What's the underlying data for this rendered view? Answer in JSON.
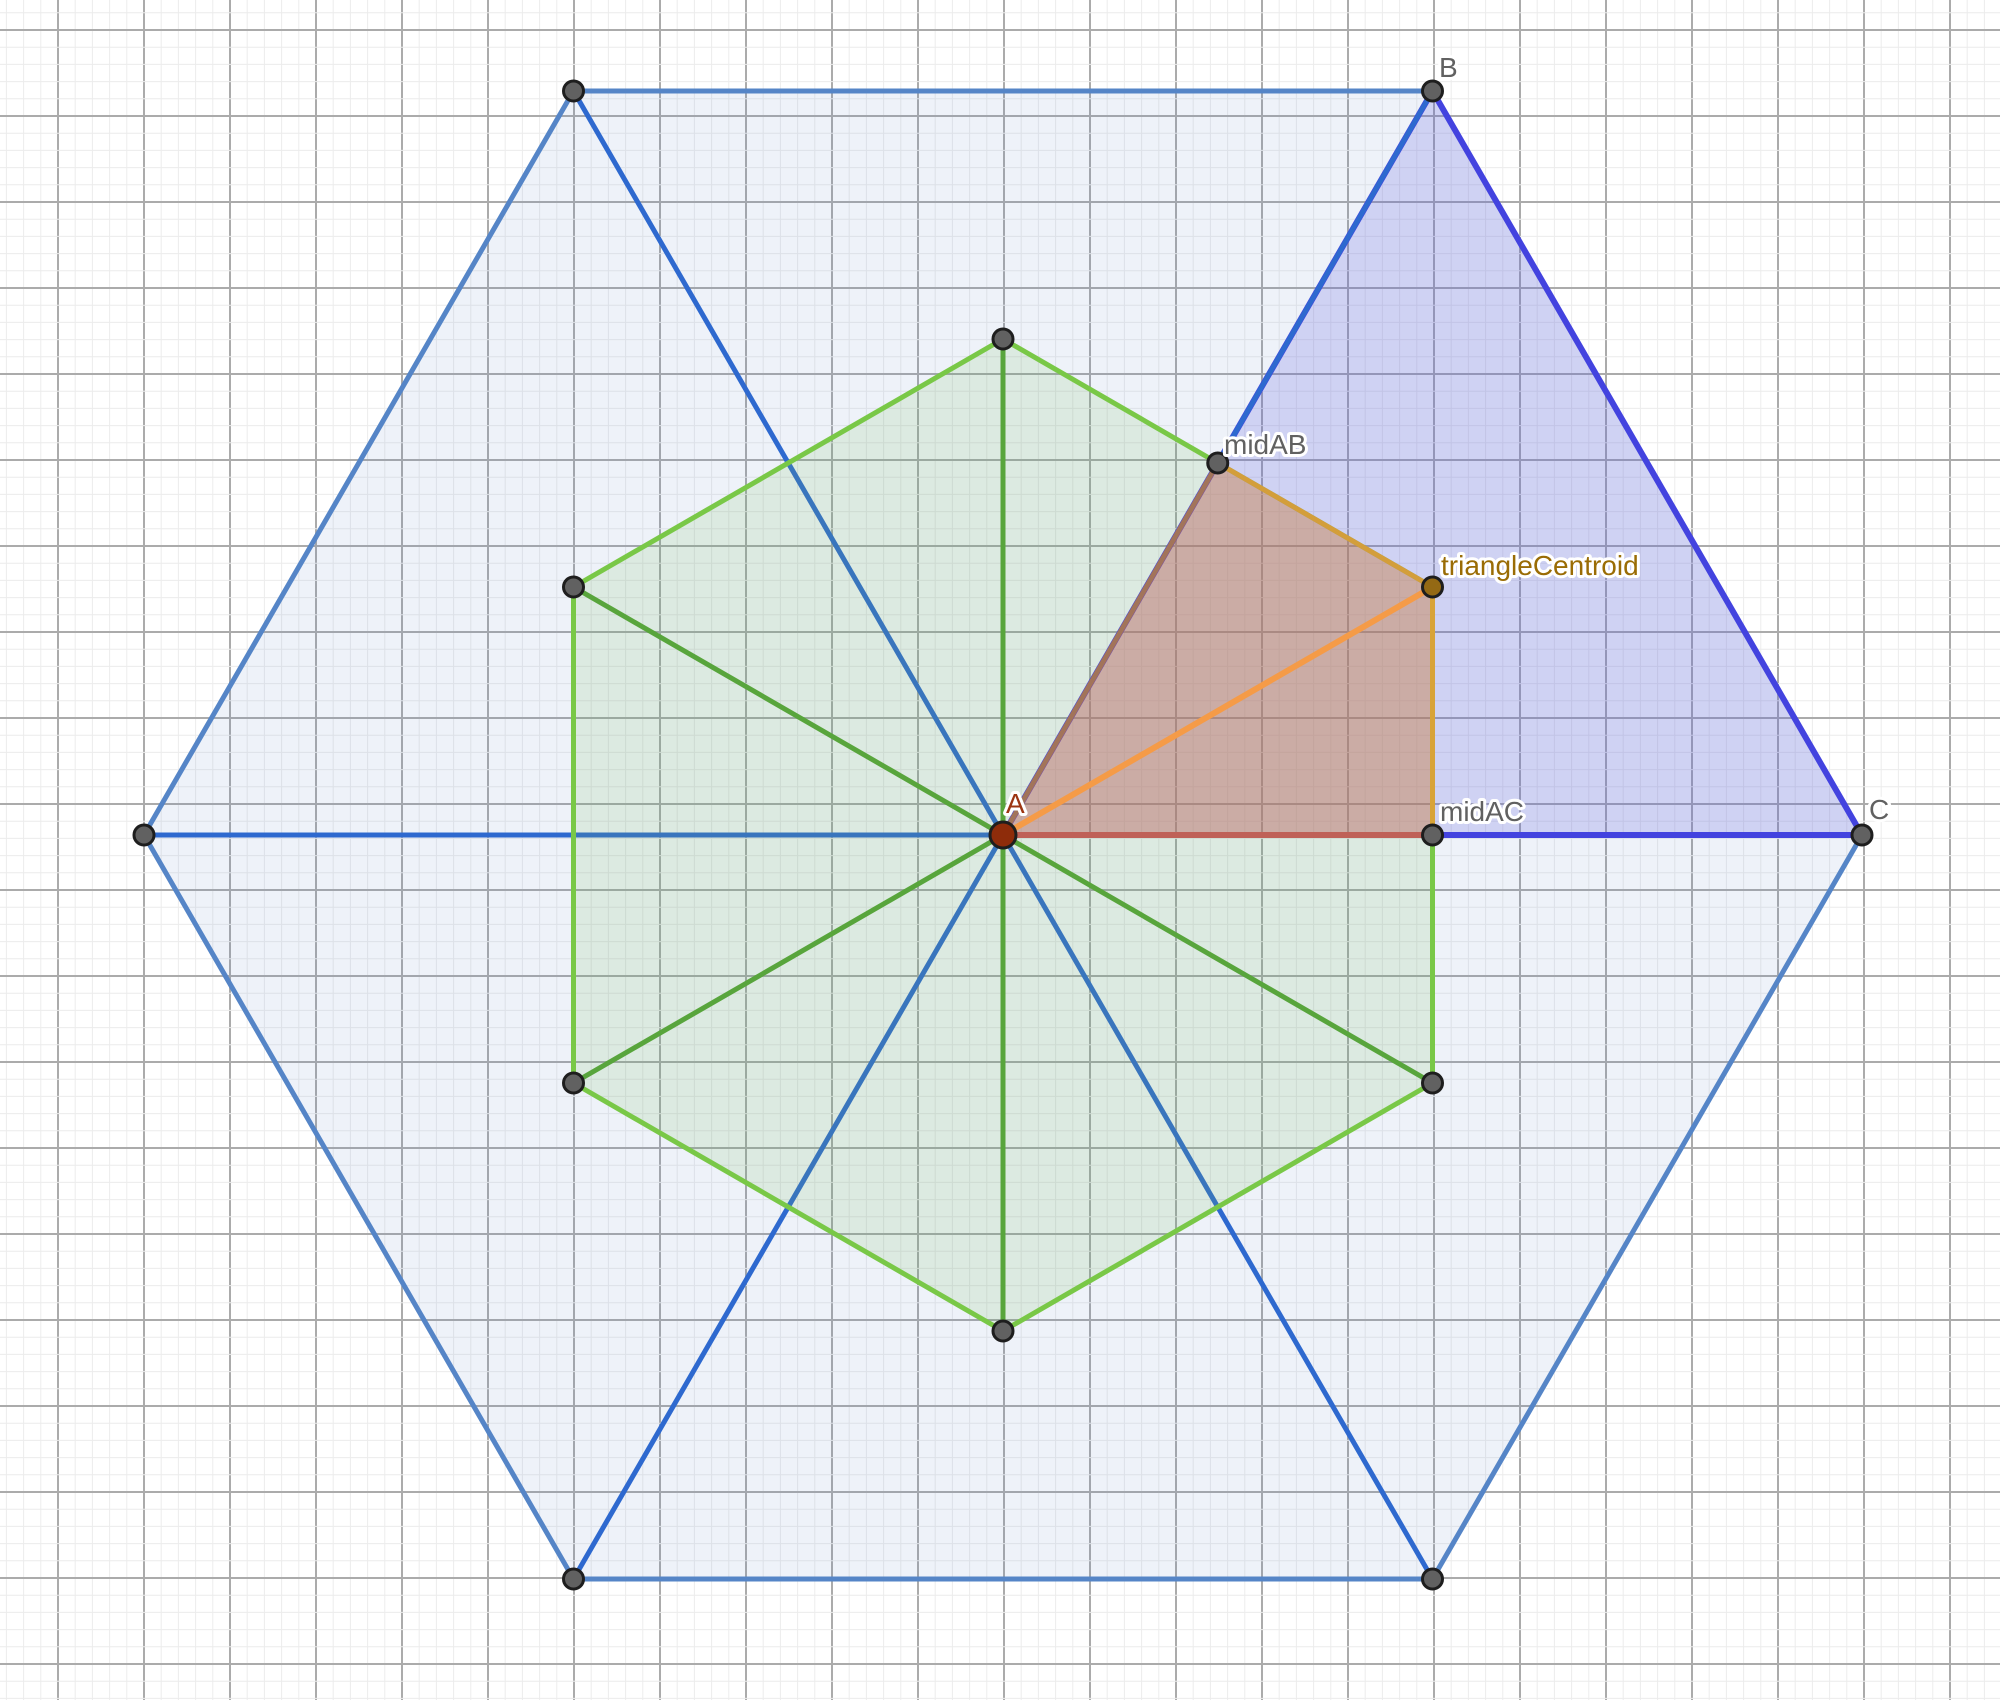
{
  "app": {
    "title": "geometry-graphics-view"
  },
  "canvas": {
    "width": 2000,
    "height": 1700,
    "background": "#ffffff"
  },
  "grid": {
    "minor_spacing": 17.2,
    "major_every": 5,
    "offset_x": 58,
    "offset_y": 30,
    "minor_color": "#ececec",
    "major_color": "#ababab",
    "minor_width": 1,
    "major_width": 2
  },
  "colors": {
    "hexagon_large_stroke": "#5585c7",
    "hexagon_large_diagonal": "#2e69cf",
    "hexagon_large_fill": "rgba(88,130,195,0.10)",
    "hexagon_green_stroke": "#79c847",
    "hexagon_green_diagonal": "#58a53c",
    "hexagon_green_fill": "rgba(120,190,90,0.15)",
    "triangle_stroke": "#4343df",
    "triangle_fill": "rgba(100,95,225,0.22)",
    "quad_fill": "rgba(225,110,45,0.33)",
    "quad_edge_brown": "#a2745a",
    "quad_edge_amber": "#d39e3b",
    "quad_edge_red": "#bf6158",
    "median_orange": "#f59b47",
    "point_gray": "#616161",
    "point_A": "#8e2c0a",
    "point_centroid": "#946914",
    "label_gray": "#616161",
    "label_A": "#9c3512",
    "label_centroid": "#9a6c05"
  },
  "shapes": [
    {
      "kind": "polygon",
      "name": "large-hexagon",
      "interactable": true,
      "points": "1862,835 1432.5,91 573.5,91 144,835 573.5,1579 1432.5,1579",
      "fill": "rgba(88,130,195,0.10)",
      "stroke": "#5585c7",
      "width": 5
    },
    {
      "kind": "segment",
      "name": "large-hexagon-diagonal-horizontal",
      "interactable": true,
      "x1": 144,
      "y1": 835,
      "x2": 1862,
      "y2": 835,
      "stroke": "#2e69cf",
      "width": 5
    },
    {
      "kind": "segment",
      "name": "large-hexagon-diagonal-topleft-bottomright",
      "interactable": true,
      "x1": 573.5,
      "y1": 91,
      "x2": 1432.5,
      "y2": 1579,
      "stroke": "#2e69cf",
      "width": 5
    },
    {
      "kind": "segment",
      "name": "large-hexagon-diagonal-topright-bottomleft",
      "interactable": true,
      "x1": 1432.5,
      "y1": 91,
      "x2": 573.5,
      "y2": 1579,
      "stroke": "#2e69cf",
      "width": 5
    },
    {
      "kind": "polygon",
      "name": "green-hexagon",
      "interactable": true,
      "points": "1432.5,587 1003,339 573.5,587 573.5,1083 1003,1331 1432.5,1083",
      "fill": "rgba(120,190,90,0.15)",
      "stroke": "#79c847",
      "width": 5
    },
    {
      "kind": "segment",
      "name": "green-hexagon-diagonal-vertical",
      "interactable": true,
      "x1": 1003,
      "y1": 339,
      "x2": 1003,
      "y2": 1331,
      "stroke": "#58a53c",
      "width": 5
    },
    {
      "kind": "segment",
      "name": "green-hexagon-diagonal-upperleft-lowerright",
      "interactable": true,
      "x1": 573.5,
      "y1": 587,
      "x2": 1432.5,
      "y2": 1083,
      "stroke": "#58a53c",
      "width": 5
    },
    {
      "kind": "segment",
      "name": "green-hexagon-diagonal-upperright-lowerleft",
      "interactable": true,
      "x1": 1432.5,
      "y1": 587,
      "x2": 573.5,
      "y2": 1083,
      "stroke": "#58a53c",
      "width": 5
    },
    {
      "kind": "polygon",
      "name": "triangle-ABC",
      "interactable": true,
      "points": "1003,835 1432.5,91 1862,835",
      "fill": "rgba(100,95,225,0.22)",
      "stroke": "#4343df",
      "width": 6
    },
    {
      "kind": "segment",
      "name": "diagonal-overlay-B-to-midAB",
      "interactable": true,
      "x1": 1432.5,
      "y1": 91,
      "x2": 1217.75,
      "y2": 463,
      "stroke": "#2e69cf",
      "width": 5
    },
    {
      "kind": "polygon",
      "name": "quad-A-midAB-centroid-midAC",
      "interactable": true,
      "points": "1003,835 1217.75,463 1432.5,587 1432.5,835",
      "fill": "rgba(225,110,45,0.33)",
      "stroke": "none",
      "width": 0
    },
    {
      "kind": "segment",
      "name": "quad-edge-A-midAB",
      "interactable": true,
      "x1": 1003,
      "y1": 835,
      "x2": 1217.75,
      "y2": 463,
      "stroke": "#a2745a",
      "width": 5
    },
    {
      "kind": "segment",
      "name": "quad-edge-midAB-centroid",
      "interactable": true,
      "x1": 1217.75,
      "y1": 463,
      "x2": 1432.5,
      "y2": 587,
      "stroke": "#d39e3b",
      "width": 5
    },
    {
      "kind": "segment",
      "name": "quad-edge-centroid-midAC",
      "interactable": true,
      "x1": 1432.5,
      "y1": 587,
      "x2": 1432.5,
      "y2": 835,
      "stroke": "#d8a338",
      "width": 5
    },
    {
      "kind": "segment",
      "name": "quad-edge-midAC-A",
      "interactable": true,
      "x1": 1432.5,
      "y1": 835,
      "x2": 1003,
      "y2": 835,
      "stroke": "#bf6158",
      "width": 6
    },
    {
      "kind": "segment",
      "name": "median-segment-A-centroid",
      "interactable": true,
      "x1": 1003,
      "y1": 835,
      "x2": 1432.5,
      "y2": 587,
      "stroke": "#f59b47",
      "width": 6
    }
  ],
  "points": [
    {
      "name": "point-hex-top-left",
      "interactable": true,
      "x": 573.5,
      "y": 91,
      "r": 10,
      "fill": "#616161",
      "stroke": "#1e1e1e"
    },
    {
      "name": "point-hex-left",
      "interactable": true,
      "x": 144,
      "y": 835,
      "r": 10,
      "fill": "#616161",
      "stroke": "#1e1e1e"
    },
    {
      "name": "point-hex-bottom-left",
      "interactable": true,
      "x": 573.5,
      "y": 1579,
      "r": 10,
      "fill": "#616161",
      "stroke": "#1e1e1e"
    },
    {
      "name": "point-hex-bottom-right",
      "interactable": true,
      "x": 1432.5,
      "y": 1579,
      "r": 10,
      "fill": "#616161",
      "stroke": "#1e1e1e"
    },
    {
      "name": "point-green-top",
      "interactable": true,
      "x": 1003,
      "y": 339,
      "r": 10,
      "fill": "#616161",
      "stroke": "#1e1e1e"
    },
    {
      "name": "point-green-upper-left",
      "interactable": true,
      "x": 573.5,
      "y": 587,
      "r": 10,
      "fill": "#616161",
      "stroke": "#1e1e1e"
    },
    {
      "name": "point-green-lower-left",
      "interactable": true,
      "x": 573.5,
      "y": 1083,
      "r": 10,
      "fill": "#616161",
      "stroke": "#1e1e1e"
    },
    {
      "name": "point-green-bottom",
      "interactable": true,
      "x": 1003,
      "y": 1331,
      "r": 10,
      "fill": "#616161",
      "stroke": "#1e1e1e"
    },
    {
      "name": "point-green-lower-right",
      "interactable": true,
      "x": 1432.5,
      "y": 1083,
      "r": 10,
      "fill": "#616161",
      "stroke": "#1e1e1e"
    },
    {
      "name": "point-B",
      "interactable": true,
      "x": 1432.5,
      "y": 91,
      "r": 10,
      "fill": "#616161",
      "stroke": "#1e1e1e"
    },
    {
      "name": "point-C",
      "interactable": true,
      "x": 1862,
      "y": 835,
      "r": 10,
      "fill": "#616161",
      "stroke": "#1e1e1e"
    },
    {
      "name": "point-midAB",
      "interactable": true,
      "x": 1217.75,
      "y": 463,
      "r": 10,
      "fill": "#616161",
      "stroke": "#1e1e1e"
    },
    {
      "name": "point-midAC",
      "interactable": true,
      "x": 1432.5,
      "y": 835,
      "r": 10,
      "fill": "#616161",
      "stroke": "#1e1e1e"
    },
    {
      "name": "point-triangleCentroid",
      "interactable": true,
      "x": 1432.5,
      "y": 587,
      "r": 10,
      "fill": "#946914",
      "stroke": "#1e1e1e"
    },
    {
      "name": "point-A",
      "interactable": true,
      "x": 1003,
      "y": 835,
      "r": 13,
      "fill": "#8e2c0a",
      "stroke": "#1e1e1e"
    }
  ],
  "labels": [
    {
      "name": "label-B",
      "text": "B",
      "x": 1439,
      "y": 77,
      "color": "#616161",
      "size": 28,
      "interactable": true
    },
    {
      "name": "label-C",
      "text": "C",
      "x": 1869,
      "y": 819,
      "color": "#616161",
      "size": 28,
      "interactable": true
    },
    {
      "name": "label-A",
      "text": "A",
      "x": 1006,
      "y": 813,
      "color": "#9c3512",
      "size": 28,
      "interactable": true
    },
    {
      "name": "label-midAB",
      "text": "midAB",
      "x": 1224,
      "y": 454,
      "color": "#616161",
      "size": 28,
      "interactable": true
    },
    {
      "name": "label-midAC",
      "text": "midAC",
      "x": 1440,
      "y": 821,
      "color": "#616161",
      "size": 28,
      "interactable": true
    },
    {
      "name": "label-triangleCentroid",
      "text": "triangleCentroid",
      "x": 1441,
      "y": 575,
      "color": "#9a6c05",
      "size": 28,
      "interactable": true
    }
  ]
}
